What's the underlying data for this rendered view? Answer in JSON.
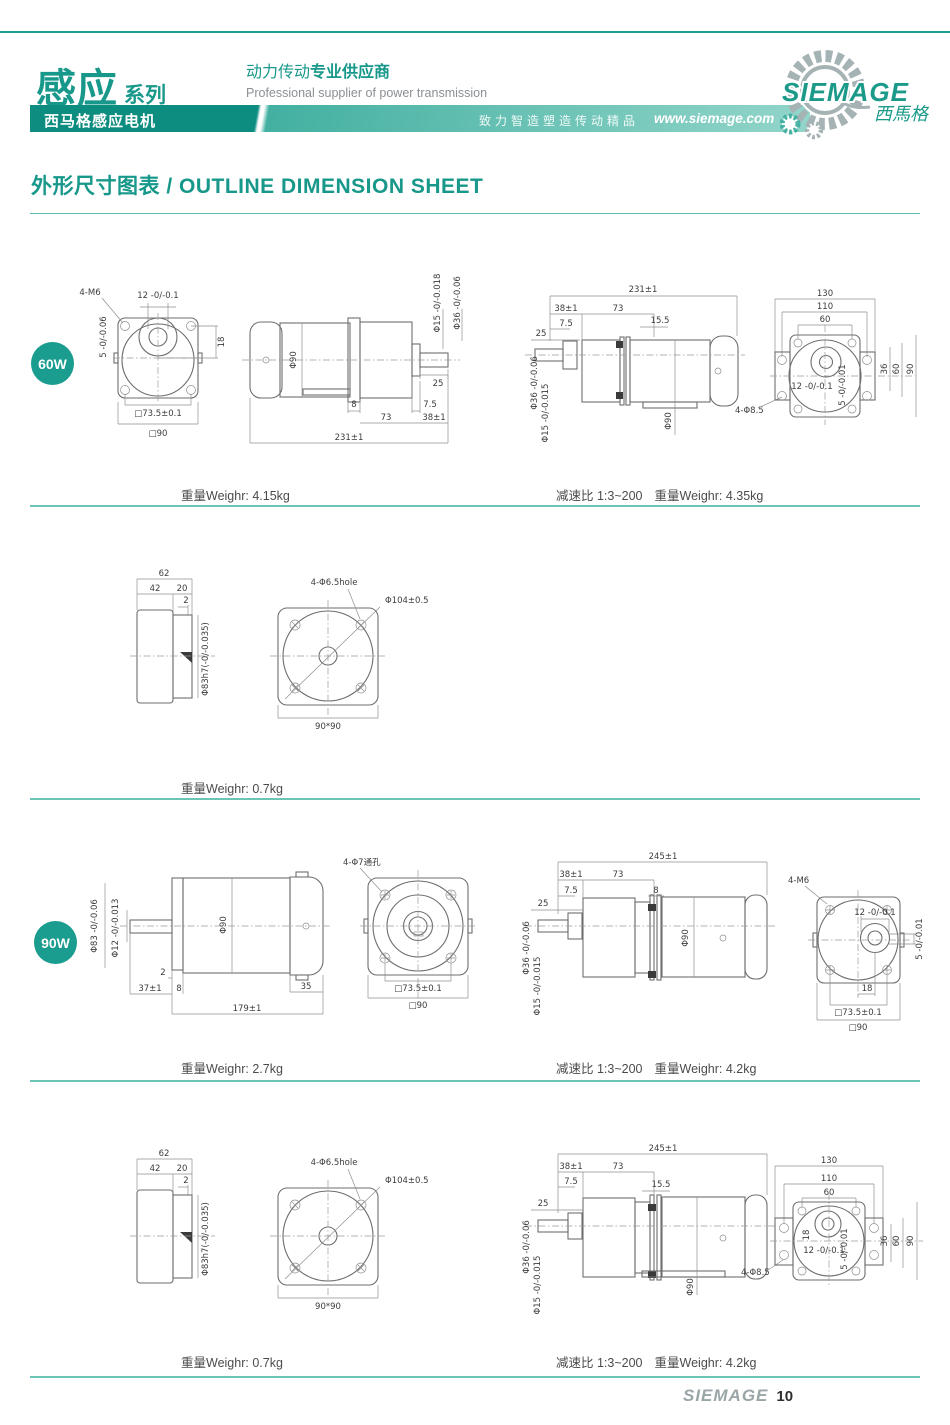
{
  "header": {
    "series_title": "感应",
    "series_subtitle": "系列",
    "supplier_cn_a": "动力传动",
    "supplier_cn_b": "专业供应商",
    "supplier_en": "Professional supplier of power transmission",
    "banner_product": "西马格感应电机",
    "banner_slogan": "致力智造塑造传动精品",
    "banner_url": "www.siemage.com",
    "logo_brand": "SIEMAGE",
    "logo_cn": "西馬格"
  },
  "page_title": "外形尺寸图表 / OUTLINE DIMENSION SHEET",
  "footer": {
    "brand": "SIEMAGE",
    "page": "10"
  },
  "sections": {
    "a": {
      "badge": "60W",
      "caption_left": "重量Weighr: 4.15kg",
      "caption_ratio": "减速比 1:3~200",
      "caption_right": "重量Weighr: 4.35kg",
      "front": {
        "bolt": "4-M6",
        "k5": "5 -0/-0.06",
        "k12": "12 -0/-0.1",
        "h18": "18",
        "sq1": "□73.5±0.1",
        "sq2": "□90"
      },
      "side": {
        "d90": "Φ90",
        "d15": "Φ15 -0/-0.018",
        "d36": "Φ36 -0/-0.06",
        "l25": "25",
        "l8": "8",
        "l73": "73",
        "l75": "7.5",
        "l38": "38±1",
        "l231": "231±1"
      },
      "gside": {
        "l231": "231±1",
        "l38": "38±1",
        "l73": "73",
        "l75": "7.5",
        "l155": "15.5",
        "l25": "25",
        "d36": "Φ36 -0/-0.06",
        "d15": "Φ15 -0/-0.015",
        "d90": "Φ90",
        "bolt": "4-Φ8.5"
      },
      "gface": {
        "l130": "130",
        "l110": "110",
        "l60": "60",
        "k12": "12 -0/-0.1",
        "k5": "5 -0/-0.01",
        "r36": "36",
        "r60": "60",
        "r90": "90"
      }
    },
    "b": {
      "caption_left": "重量Weighr: 0.7kg",
      "side": {
        "l62": "62",
        "l42": "42",
        "l20": "20",
        "l2": "2",
        "d83": "Φ83h7(-0/-0.035)"
      },
      "face": {
        "bolt": "4-Φ6.5hole",
        "d104": "Φ104±0.5",
        "sq": "90*90"
      }
    },
    "c": {
      "badge": "90W",
      "caption_left": "重量Weighr: 2.7kg",
      "caption_ratio": "减速比 1:3~200",
      "caption_right": "重量Weighr: 4.2kg",
      "side": {
        "d83": "Φ83 -0/-0.06",
        "d12": "Φ12 -0/-0.013",
        "d90": "Φ90",
        "l2": "2",
        "l37": "37±1",
        "l8": "8",
        "l35": "35",
        "l179": "179±1",
        "bolt": "4-Φ7通孔"
      },
      "front": {
        "sq1": "□73.5±0.1",
        "sq2": "□90"
      },
      "gside": {
        "l245": "245±1",
        "l38": "38±1",
        "l73": "73",
        "l75": "7.5",
        "l8": "8",
        "l25": "25",
        "d36": "Φ36 -0/-0.06",
        "d15": "Φ15 -0/-0.015",
        "d90": "Φ90"
      },
      "rear": {
        "bolt": "4-M6",
        "k12": "12 -0/-0.1",
        "k5": "5 -0/-0.01",
        "h18": "18",
        "sq1": "□73.5±0.1",
        "sq2": "□90"
      }
    },
    "d": {
      "caption_left": "重量Weighr: 0.7kg",
      "caption_ratio": "减速比 1:3~200",
      "caption_right": "重量Weighr: 4.2kg",
      "side": {
        "l62": "62",
        "l42": "42",
        "l20": "20",
        "l2": "2",
        "d83": "Φ83h7(-0/-0.035)"
      },
      "face": {
        "bolt": "4-Φ6.5hole",
        "d104": "Φ104±0.5",
        "sq": "90*90"
      },
      "gside": {
        "l245": "245±1",
        "l38": "38±1",
        "l73": "73",
        "l75": "7.5",
        "l155": "15.5",
        "l25": "25",
        "d36": "Φ36 -0/-0.06",
        "d15": "Φ15 -0/-0.015",
        "d90": "Φ90",
        "bolt": "4-Φ8.5"
      },
      "gface": {
        "l130": "130",
        "l110": "110",
        "l60": "60",
        "h18": "18",
        "k12": "12 -0/-0.1",
        "k5": "5 -0/-0.01",
        "r36": "36",
        "r60": "60",
        "r90": "90"
      }
    }
  }
}
